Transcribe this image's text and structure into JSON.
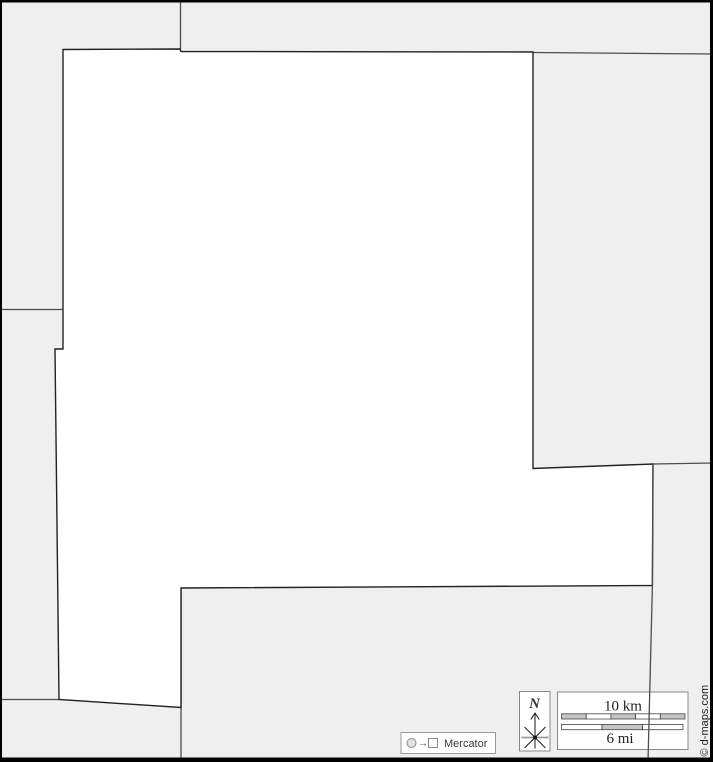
{
  "map": {
    "width": 713,
    "height": 762,
    "colors": {
      "neighbor_fill": "#efefef",
      "subject_fill": "#ffffff",
      "border_line": "#4d4d4d",
      "subject_outline": "#222222",
      "frame": "#000000",
      "box_fill": "#ffffff",
      "box_border": "#888888",
      "scale_segment_gray": "#c4c4c4",
      "text_dark": "#222222"
    },
    "subject_region": {
      "name": "highlighted-area",
      "points": "63,49.5 180,49 181,51.5 533,52 533,468.5 653,464 652.4,585.5 181,588 181,707.5 59,699.5 55,349 63,349"
    },
    "neighbor_borders": [
      {
        "name": "border-topleft-vertical",
        "points": "180.5,2 180.5,49.5",
        "overlay": false
      },
      {
        "name": "border-left-horizontal",
        "points": "0,309.5 63,309.5",
        "overlay": false
      },
      {
        "name": "border-topright-horizontal",
        "points": "533,52.5 713,54",
        "overlay": false
      },
      {
        "name": "border-right-slant",
        "points": "653,464 713,463",
        "overlay": false
      },
      {
        "name": "border-bottomleft-horizontal",
        "points": "0,699.5 59,699.5",
        "overlay": false
      },
      {
        "name": "border-bottom-vertical-left",
        "points": "181,588 181,762",
        "overlay": false
      },
      {
        "name": "border-bottom-vertical-right",
        "points": "653,464 652.4,585.5 648,762",
        "overlay": true
      }
    ]
  },
  "north_indicator": {
    "label": "N"
  },
  "scale_bar": {
    "km_label": "10 km",
    "mi_label": "6 mi",
    "km_bar": {
      "x": 561.5,
      "y": 713.8,
      "h": 5.2,
      "seg_w": 24.7,
      "fills": [
        "gray",
        "white",
        "gray",
        "white",
        "gray"
      ]
    },
    "mi_bar": {
      "x": 561.5,
      "y": 724.5,
      "h": 5.2,
      "seg_w": 40.5,
      "fills": [
        "white",
        "gray",
        "white"
      ]
    }
  },
  "projection_badge": {
    "label": "Mercator",
    "arrow": "→"
  },
  "copyright": {
    "text": "© d-maps.com"
  }
}
